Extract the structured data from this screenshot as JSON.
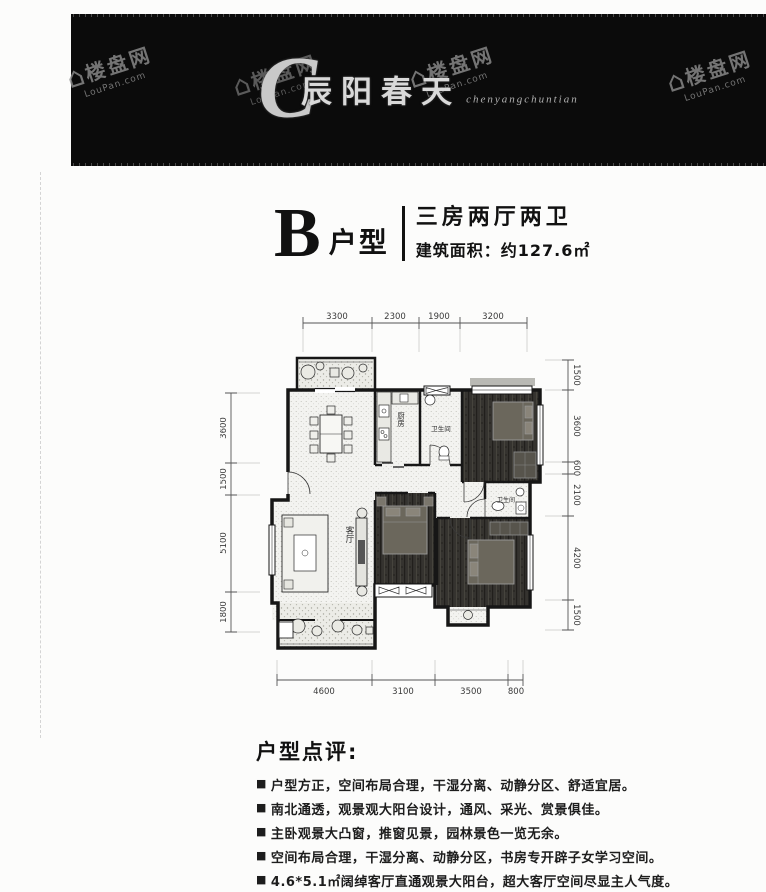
{
  "watermark": {
    "icon": "⌂",
    "name": "楼盘网",
    "domain": "LouPan.com"
  },
  "header": {
    "logo_initial": "C",
    "logo_name": "辰阳春天",
    "logo_script": "chenyangchuntian"
  },
  "title": {
    "plan_letter": "B",
    "plan_label": "户型",
    "layout": "三房两厅两卫",
    "area": "建筑面积：约127.6㎡"
  },
  "plan": {
    "rooms": {
      "kitchen": "厨房",
      "bath_top": "卫生间",
      "living": "客厅",
      "bath_right": "卫生间"
    },
    "dims": {
      "top": [
        "3300",
        "2300",
        "1900",
        "3200"
      ],
      "left": [
        "3600",
        "1500",
        "5100",
        "1800"
      ],
      "right": [
        "1500",
        "3600",
        "600",
        "2100",
        "4200",
        "1500"
      ],
      "bottom": [
        "4600",
        "3100",
        "3500",
        "800"
      ]
    }
  },
  "review": {
    "heading": "户型点评:",
    "marker": "■",
    "bullets": [
      "户型方正，空间布局合理，干湿分离、动静分区、舒适宜居。",
      "南北通透，观景观大阳台设计，通风、采光、赏景俱佳。",
      "主卧观景大凸窗，推窗见景，园林景色一览无余。",
      "空间布局合理，干湿分离、动静分区，书房专开辟子女学习空间。",
      "4.6*5.1㎡阔绰客厅直通观景大阳台，超大客厅空间尽显主人气度。"
    ]
  }
}
